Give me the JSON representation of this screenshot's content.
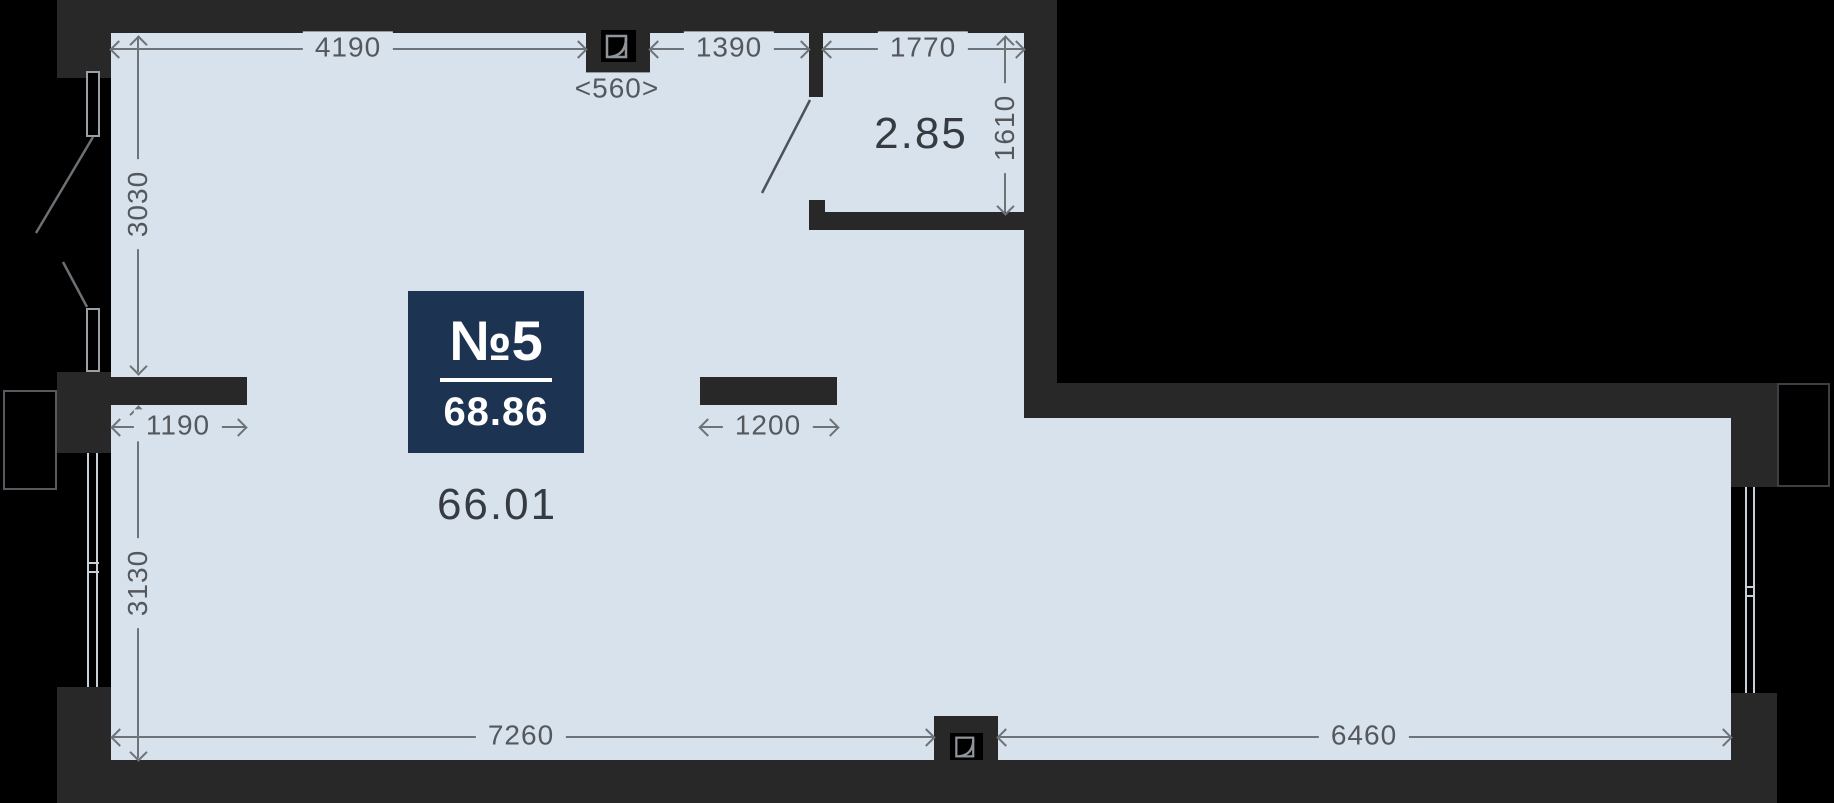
{
  "colors": {
    "background": "#000000",
    "wall": "#282828",
    "floor": "#d8e2ed",
    "dim_line": "#6e7378",
    "dim_text": "#54585d",
    "area_text": "#363b41",
    "badge_bg": "#1c3451",
    "badge_text": "#ffffff",
    "window_line": "#c7cfd8"
  },
  "unit_badge": {
    "number": "№5",
    "area": "68.86"
  },
  "room_areas": {
    "living": "66.01",
    "bathroom": "2.85"
  },
  "dimensions_mm": {
    "top_wall_left": "4190",
    "shaft_width": "<560>",
    "top_wall_mid": "1390",
    "bathroom_width": "1770",
    "bathroom_depth": "1610",
    "left_wall_upper": "3030",
    "left_stub": "1190",
    "mid_stub": "1200",
    "left_wall_lower": "3130",
    "bottom_left": "7260",
    "bottom_right": "6460"
  }
}
